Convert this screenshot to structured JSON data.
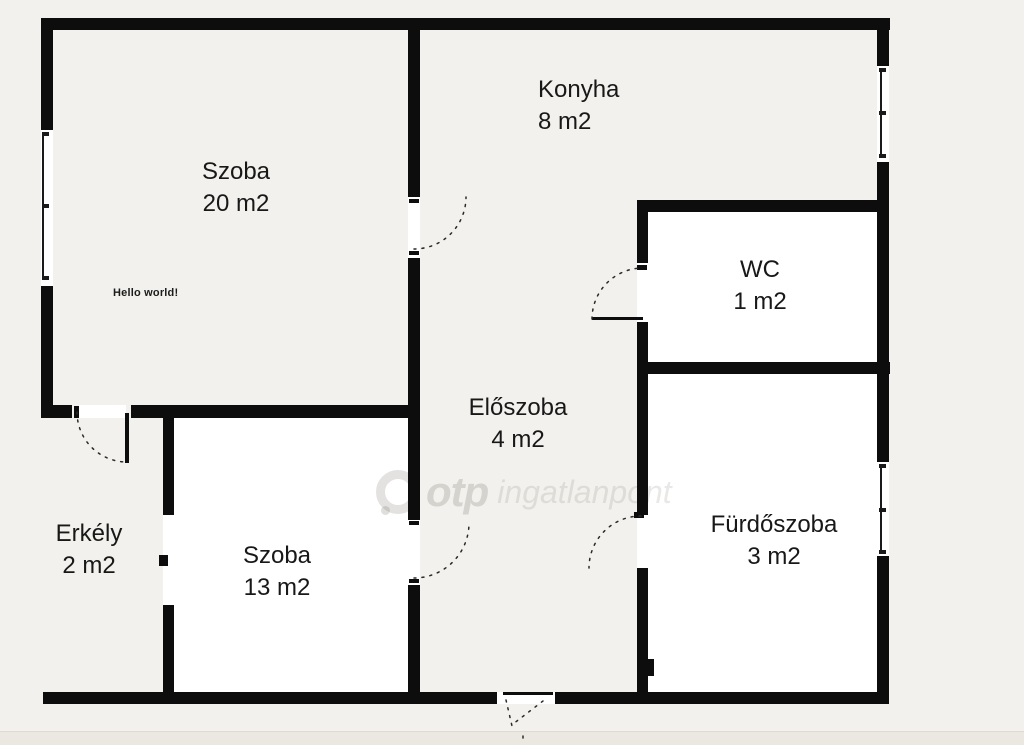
{
  "plan": {
    "type": "apartment-floor-plan",
    "background_color": "#f2f1ed",
    "wall_color": "#0d0d0d",
    "room_fill_color": "#ffffff"
  },
  "rooms": [
    {
      "id": "szoba-20",
      "name": "Szoba",
      "area": "20 m2"
    },
    {
      "id": "konyha",
      "name": "Konyha",
      "area": "8 m2"
    },
    {
      "id": "wc",
      "name": "WC",
      "area": "1 m2"
    },
    {
      "id": "eloszoba",
      "name": "Előszoba",
      "area": "4 m2"
    },
    {
      "id": "erkely",
      "name": "Erkély",
      "area": "2 m2"
    },
    {
      "id": "szoba-13",
      "name": "Szoba",
      "area": "13 m2"
    },
    {
      "id": "furdoszoba",
      "name": "Fürdőszoba",
      "area": "3 m2"
    }
  ],
  "annotation": "Hello world!",
  "watermark": {
    "brand": "otp",
    "suffix": "ingatlanpont"
  }
}
